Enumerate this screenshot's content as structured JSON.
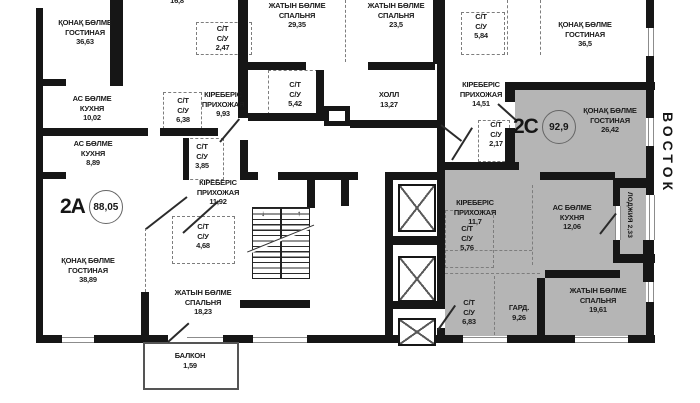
{
  "compass": {
    "east_label": "ВОСТОК"
  },
  "apartments": {
    "a2a": {
      "label": "2A",
      "area": "88,05"
    },
    "a2c": {
      "label": "2C",
      "area": "92,9"
    }
  },
  "rooms": {
    "tl_living": {
      "name1": "ҚОНАҚ БӨЛМЕ",
      "name2": "ГОСТИНАЯ",
      "area": "36,63"
    },
    "tl_room_cut": {
      "area": "16,8"
    },
    "tl_bath": {
      "name1": "С/Т",
      "name2": "С/У",
      "area": "2,47"
    },
    "tl_kitchen": {
      "name1": "АС БӨЛМЕ",
      "name2": "КУХНЯ",
      "area": "10,02"
    },
    "tl_bath2": {
      "name1": "С/Т",
      "name2": "С/У",
      "area": "6,38"
    },
    "tl_hallway": {
      "name1": "КІРЕБЕРІС",
      "name2": "ПРИХОЖАЯ",
      "area": "9,93"
    },
    "tm_bedroom1": {
      "name1": "ЖАТЫН БӨЛМЕ",
      "name2": "СПАЛЬНЯ",
      "area": "29,35"
    },
    "tm_bedroom2": {
      "name1": "ЖАТЫН БӨЛМЕ",
      "name2": "СПАЛЬНЯ",
      "area": "23,5"
    },
    "tm_bath1": {
      "name1": "С/Т",
      "name2": "С/У",
      "area": "5,42"
    },
    "tm_hall": {
      "name1": "ХОЛЛ",
      "area": "13,27"
    },
    "tr_bath": {
      "name1": "С/Т",
      "name2": "С/У",
      "area": "5,84"
    },
    "tr_living": {
      "name1": "ҚОНАҚ БӨЛМЕ",
      "name2": "ГОСТИНАЯ",
      "area": "36,5"
    },
    "tr_hallway": {
      "name1": "КІРЕБЕРІС",
      "name2": "ПРИХОЖАЯ",
      "area": "14,51"
    },
    "tr_bath2": {
      "name1": "С/Т",
      "name2": "С/У",
      "area": "2,17"
    },
    "a_kitchen": {
      "name1": "АС БӨЛМЕ",
      "name2": "КУХНЯ",
      "area": "8,89"
    },
    "a_bath1": {
      "name1": "С/Т",
      "name2": "С/У",
      "area": "3,85"
    },
    "a_hallway": {
      "name1": "КІРЕБЕРІС",
      "name2": "ПРИХОЖАЯ",
      "area": "11,92"
    },
    "a_bath2": {
      "name1": "С/Т",
      "name2": "С/У",
      "area": "4,68"
    },
    "a_living": {
      "name1": "ҚОНАҚ БӨЛМЕ",
      "name2": "ГОСТИНАЯ",
      "area": "38,89"
    },
    "a_bedroom": {
      "name1": "ЖАТЫН БӨЛМЕ",
      "name2": "СПАЛЬНЯ",
      "area": "18,23"
    },
    "a_balcony": {
      "name1": "БАЛКОН",
      "area": "1,59"
    },
    "c_living": {
      "name1": "ҚОНАҚ БӨЛМЕ",
      "name2": "ГОСТИНАЯ",
      "area": "26,42"
    },
    "c_hallway": {
      "name1": "КІРЕБЕРІС",
      "name2": "ПРИХОЖАЯ",
      "area": "11,7"
    },
    "c_bath1": {
      "name1": "С/Т",
      "name2": "С/У",
      "area": "5,76"
    },
    "c_kitchen": {
      "name1": "АС БӨЛМЕ",
      "name2": "КУХНЯ",
      "area": "12,06"
    },
    "c_loggia": {
      "name1": "ЛОДЖИЯ",
      "area": "2,33"
    },
    "c_bath2": {
      "name1": "С/Т",
      "name2": "С/У",
      "area": "6,83"
    },
    "c_wardrobe": {
      "name1": "ГАРД.",
      "area": "9,26"
    },
    "c_bedroom": {
      "name1": "ЖАТЫН БӨЛМЕ",
      "name2": "СПАЛЬНЯ",
      "area": "19,61"
    }
  },
  "colors": {
    "wall": "#161616",
    "apartment_2c_fill": "#b5b5b5"
  }
}
